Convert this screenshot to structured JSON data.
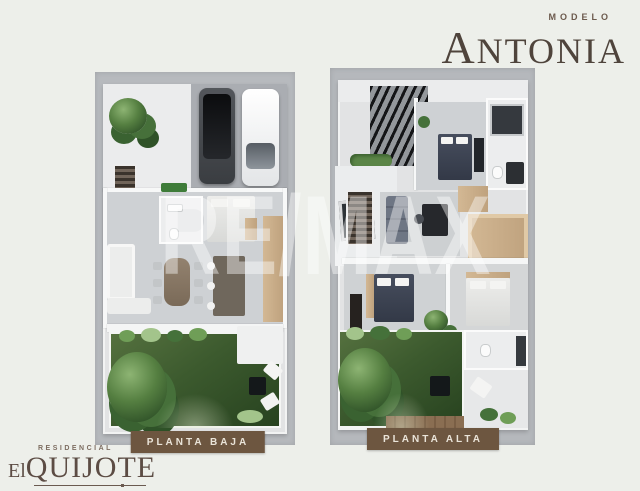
{
  "header": {
    "model_label": "MODELO",
    "model_name": "ANTONIA"
  },
  "watermark": {
    "text": "RE/MAX"
  },
  "plans": [
    {
      "id": "planta-baja",
      "label": "PLANTA BAJA"
    },
    {
      "id": "planta-alta",
      "label": "PLANTA ALTA"
    }
  ],
  "brand": {
    "residential_label": "RESIDENCIAL",
    "name_prefix": "El",
    "name": "QUIJOTE"
  },
  "colors": {
    "page_bg": "#EDEFEA",
    "panel_gray": "#B7BABE",
    "badge_brown": "#6D5640",
    "title_brown": "#4F443C",
    "logo_brown": "#5C4C44",
    "watermark_white": "rgba(255,255,255,0.42)",
    "grass_green": "#3C5A2E",
    "wood_tan": "#C9AD8B"
  }
}
